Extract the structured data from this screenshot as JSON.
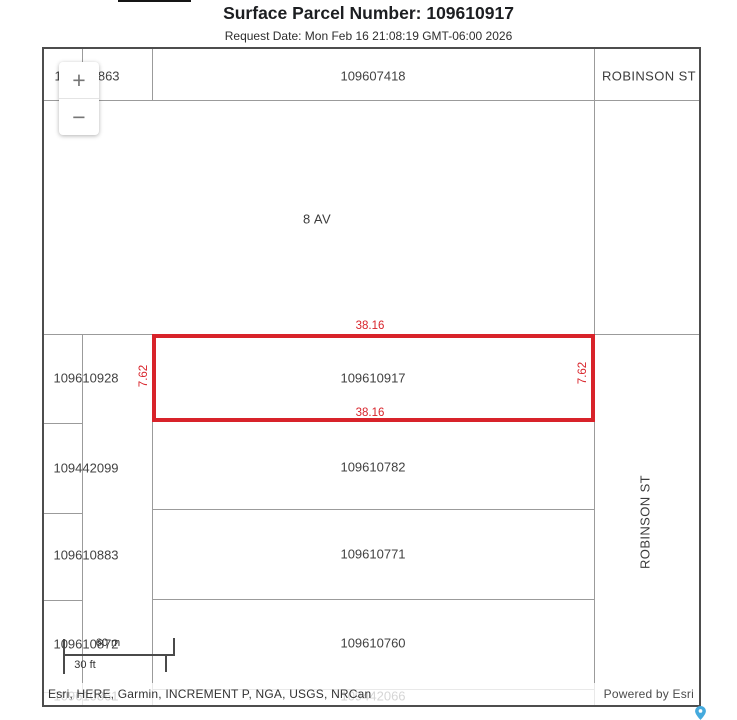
{
  "header": {
    "title": "Surface Parcel Number: 109610917",
    "request_date": "Request Date: Mon Feb 16 21:08:19 GMT-06:00 2026"
  },
  "map": {
    "zoom_control": {
      "zoom_in": "+",
      "zoom_out": "−"
    },
    "streets": {
      "avenue": "8 AV",
      "robinson_top": "ROBINSON ST",
      "robinson_side": "ROBINSON ST"
    },
    "parcels": {
      "top_left": "109610863",
      "top_center": "109607418",
      "row1_left": "109610928",
      "row2_left": "109442099",
      "row2_main": "109610782",
      "row3_left": "109610883",
      "row3_main": "109610771",
      "row4_left": "109610872",
      "row4_main": "109610760",
      "row5_left": "109610861",
      "row5_main": "109442066"
    },
    "selected_parcel": {
      "number": "109610917",
      "dim_top": "38.16",
      "dim_bottom": "38.16",
      "dim_left": "7.62",
      "dim_right": "7.62",
      "outline_color": "#d8232a"
    },
    "scale_bar": {
      "metric_label": "60 m",
      "imperial_label": "30 ft"
    },
    "attribution": {
      "sources": "Esri, HERE, Garmin, INCREMENT P, NGA, USGS, NRCan",
      "powered_by": "Powered by Esri"
    }
  }
}
